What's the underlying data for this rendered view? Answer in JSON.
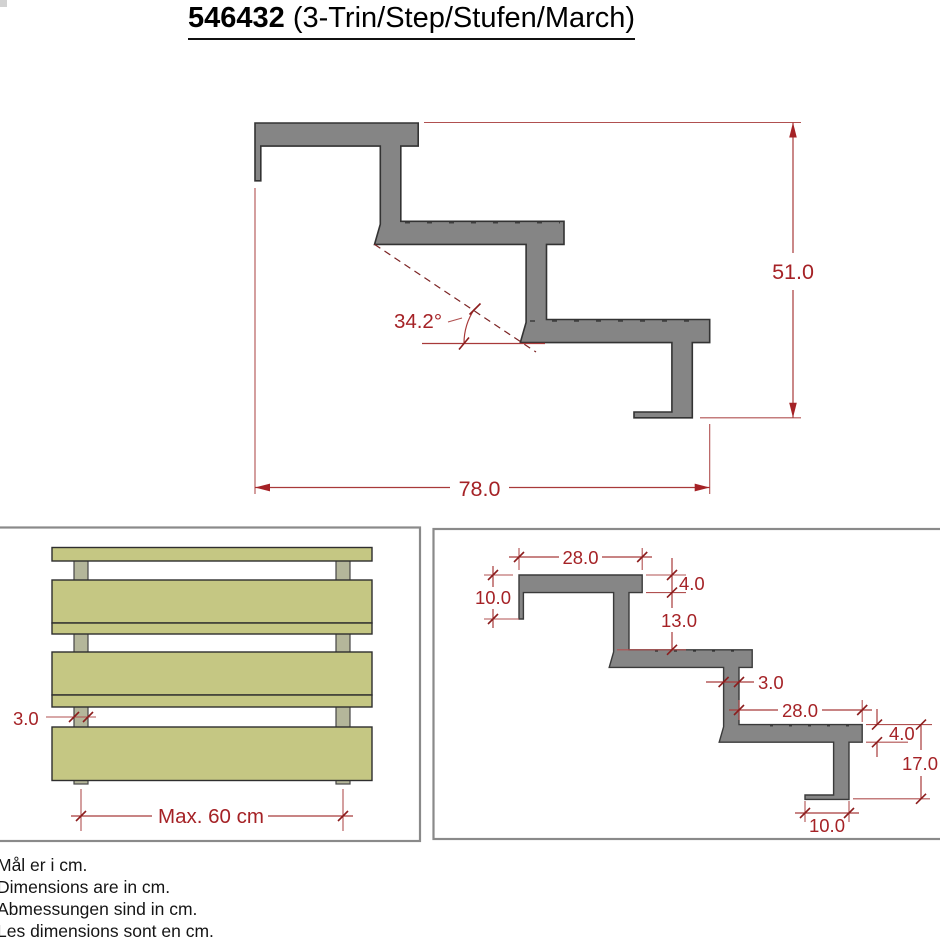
{
  "title": {
    "number": "546432",
    "rest": " (3-Trin/Step/Stufen/March)"
  },
  "main_view": {
    "total_run": "78.0",
    "total_rise": "51.0",
    "angle": "34.2°"
  },
  "front_view": {
    "stringer_thickness": "3.0",
    "max_spacing": "Max. 60 cm"
  },
  "detail_view": {
    "tread_length_top": "28.0",
    "tread_thickness_top": "4.0",
    "hanger_drop": "10.0",
    "riser_clear": "13.0",
    "stringer_thickness": "3.0",
    "tread_length_bottom": "28.0",
    "tread_thickness_bottom": "4.0",
    "bottom_rise": "17.0",
    "foot_length": "10.0"
  },
  "footer": {
    "lines": [
      "Mål er i cm.",
      "Dimensions are in cm.",
      "Abmessungen sind in cm.",
      "Les dimensions sont en cm."
    ]
  },
  "colors": {
    "dimension_red": "#a52226",
    "steel_gray": "#858585",
    "wood_green": "#c5c783",
    "post_green": "#b4b69a",
    "panel_border": "#8a8a8a"
  }
}
